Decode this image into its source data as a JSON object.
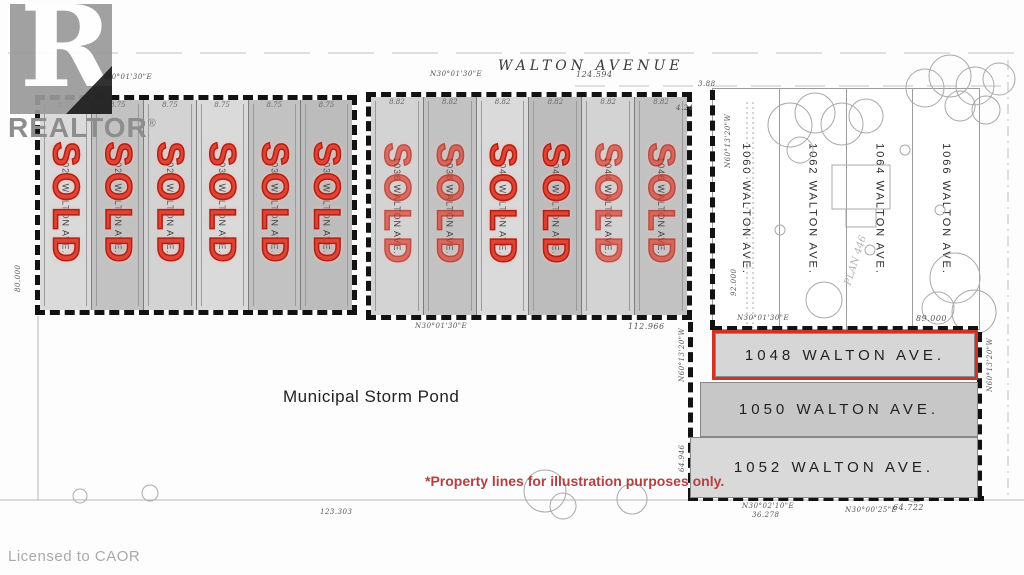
{
  "branding": {
    "logo_letter": "R",
    "logo_word": "REALTOR",
    "registered_mark": "®",
    "licensed": "Licensed to CAOR"
  },
  "street": {
    "name": "WALTON AVENUE"
  },
  "labels": {
    "sold": "SOLD",
    "pond": "Municipal Storm Pond",
    "disclaimer": "*Property lines for illustration purposes only.",
    "plan": "PLAN 446"
  },
  "left_block": {
    "lot_width": "8.75",
    "lots": [
      {
        "address": "1024 WALTON AVE.",
        "status": "SOLD"
      },
      {
        "address": "1026 WALTON AVE.",
        "status": "SOLD"
      },
      {
        "address": "1028 WALTON AVE.",
        "status": "SOLD"
      },
      {
        "address": "1030 WALTON AVE.",
        "status": "SOLD"
      },
      {
        "address": "1032 WALTON AVE.",
        "status": "SOLD"
      },
      {
        "address": "1034 WALTON AVE.",
        "status": "SOLD"
      }
    ]
  },
  "middle_block": {
    "lot_width": "8.82",
    "lots": [
      {
        "address": "1036 WALTON AVE.",
        "status": "SOLD"
      },
      {
        "address": "1038 WALTON AVE.",
        "status": "SOLD"
      },
      {
        "address": "1040 WALTON AVE.",
        "status": "SOLD"
      },
      {
        "address": "1042 WALTON AVE.",
        "status": "SOLD"
      },
      {
        "address": "1044 WALTON AVE.",
        "status": "SOLD"
      },
      {
        "address": "1046 WALTON AVE.",
        "status": "SOLD"
      }
    ]
  },
  "right_block": {
    "lots": [
      {
        "address": "1060 WALTON AVE."
      },
      {
        "address": "1062 WALTON AVE."
      },
      {
        "address": "1064 WALTON AVE."
      },
      {
        "address": "1066 WALTON AVE."
      }
    ]
  },
  "available": {
    "featured": {
      "address": "1048 WALTON AVE."
    },
    "others": [
      {
        "address": "1050 WALTON AVE."
      },
      {
        "address": "1052 WALTON AVE."
      }
    ]
  },
  "measurements": {
    "bearing_3001": "N30°01'30\"E",
    "bearing_3002": "N30°02'10\"E",
    "bearing_3000": "N30°00'25\"E",
    "bearing_6013": "N60°13'20\"W",
    "d_124": "124.594",
    "d_112": "112.966",
    "d_89": "89.000",
    "d_80": "80.000",
    "d_92": "92.000",
    "d_64946": "64.946",
    "d_36278": "36.278",
    "d_64722": "64.722",
    "d_388": "3.88",
    "d_424": "4.24",
    "d_123": "123.303"
  }
}
